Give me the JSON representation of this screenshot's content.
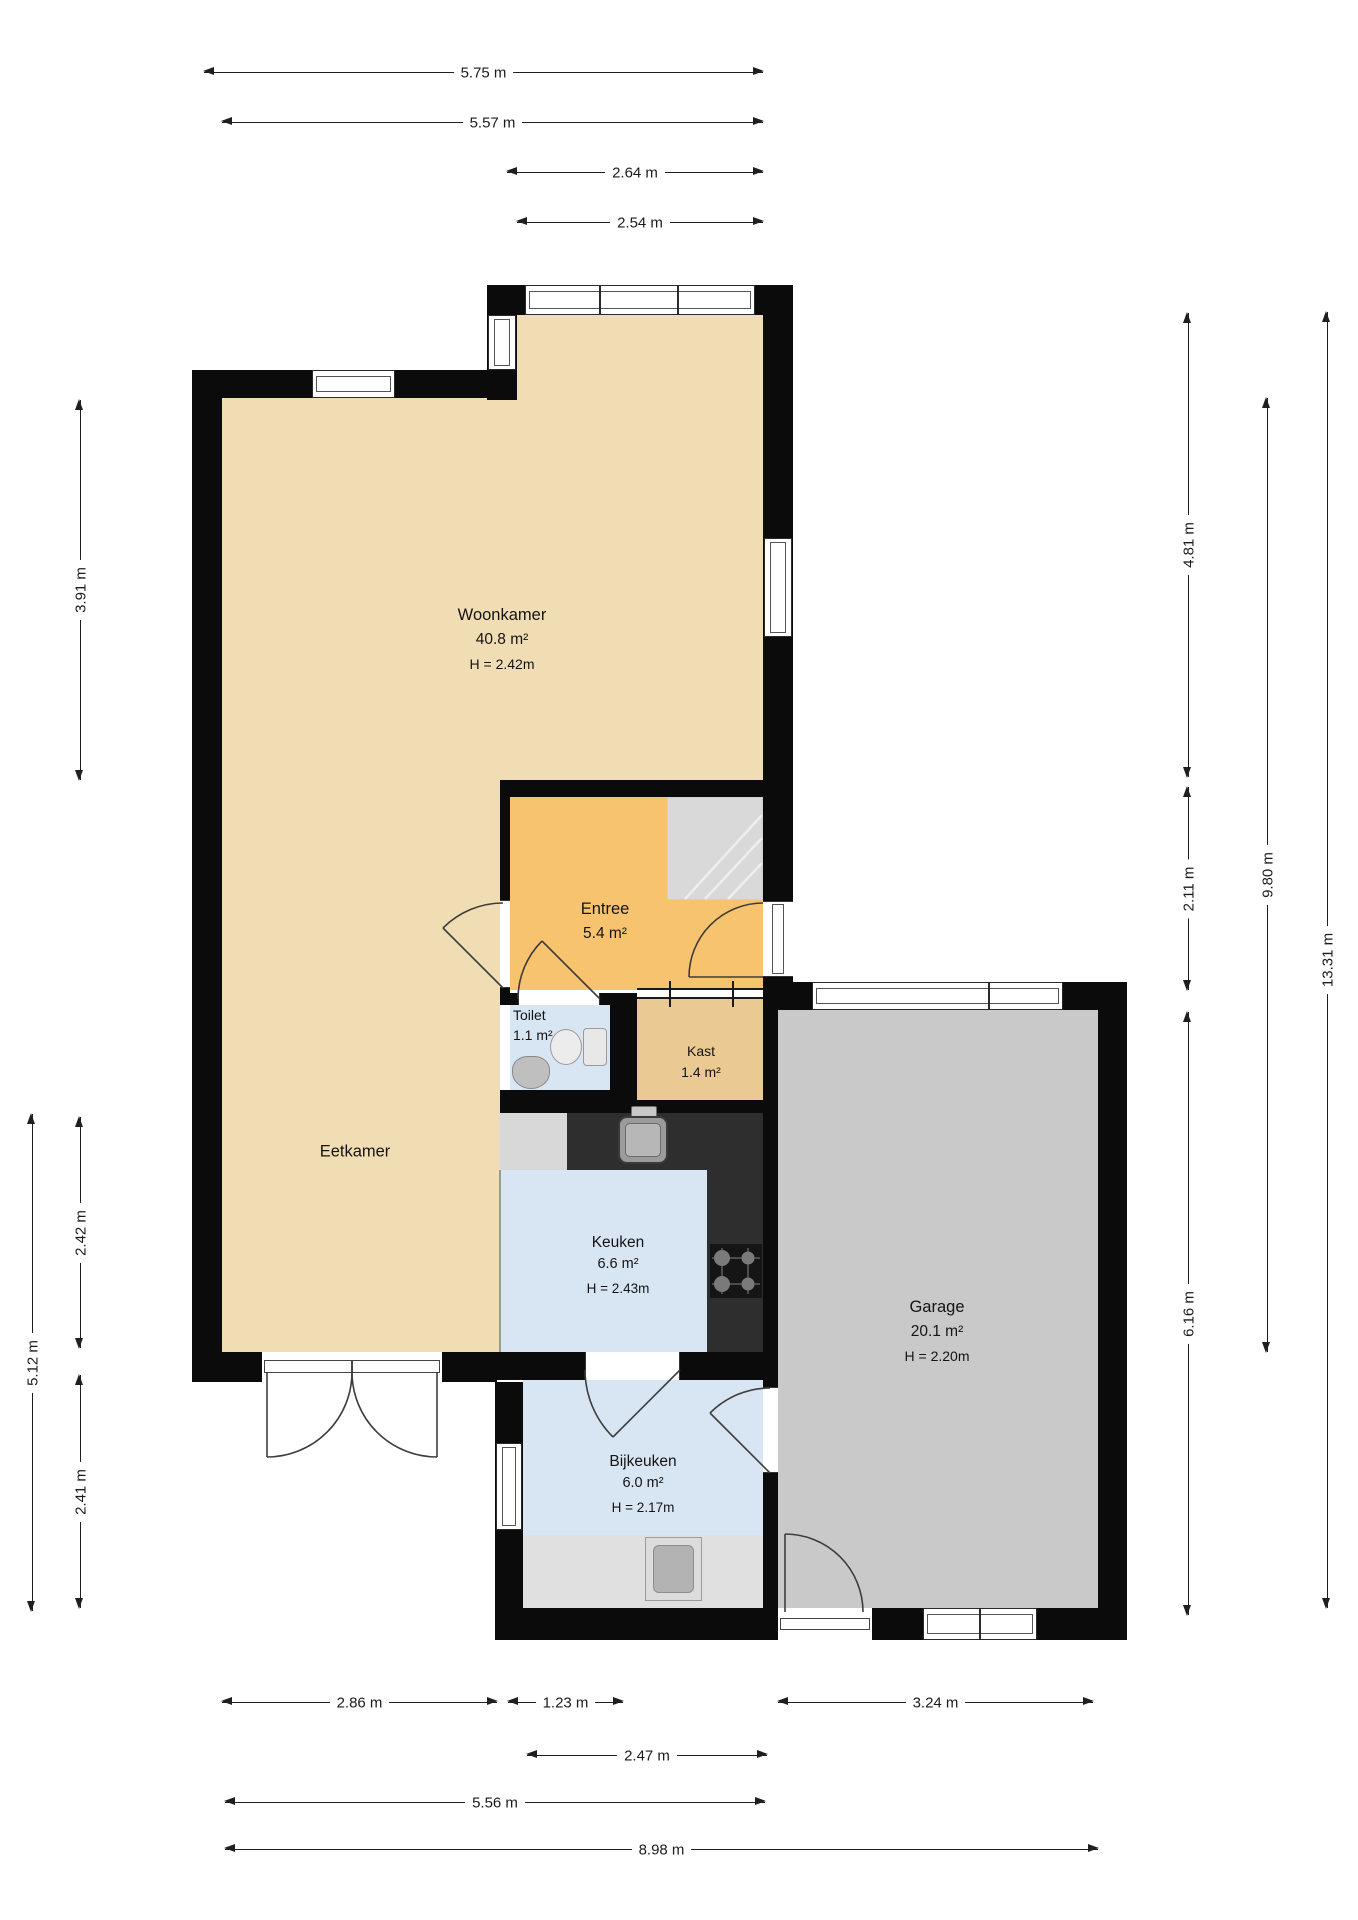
{
  "rooms": {
    "woonkamer": {
      "name": "Woonkamer",
      "area": "40.8 m²",
      "ceiling": "H = 2.42m"
    },
    "entree": {
      "name": "Entree",
      "area": "5.4 m²"
    },
    "toilet": {
      "name": "Toilet",
      "area": "1.1 m²"
    },
    "kast": {
      "name": "Kast",
      "area": "1.4 m²"
    },
    "eetkamer": {
      "name": "Eetkamer"
    },
    "keuken": {
      "name": "Keuken",
      "area": "6.6 m²",
      "ceiling": "H = 2.43m"
    },
    "bijkeuken": {
      "name": "Bijkeuken",
      "area": "6.0 m²",
      "ceiling": "H = 2.17m"
    },
    "garage": {
      "name": "Garage",
      "area": "20.1 m²",
      "ceiling": "H = 2.20m"
    }
  },
  "dimensions": {
    "top": [
      "5.75 m",
      "5.57 m",
      "2.64 m",
      "2.54 m"
    ],
    "bottom": [
      "2.86 m",
      "1.23 m",
      "3.24 m",
      "2.47 m",
      "5.56 m",
      "8.98 m"
    ],
    "left": [
      "3.91 m",
      "2.42 m",
      "2.41 m",
      "5.12 m"
    ],
    "right": [
      "4.81 m",
      "2.11 m",
      "6.16 m",
      "9.80 m",
      "13.31 m"
    ]
  },
  "colors": {
    "wall": "#0b0b0b",
    "floor_living": "#f1ddb4",
    "floor_entree": "#f8c36e",
    "floor_kast": "#ebc993",
    "floor_wet": "#d8e5f3",
    "floor_garage": "#c9c9c9",
    "counter_dark": "#2e2e2e",
    "cabinet_gray": "#d8d8d8",
    "stairs_gray": "#d9d9d9",
    "dimension_text": "#1b1b1b"
  },
  "icons": [
    "stairs-icon",
    "toilet-icon",
    "washbasin-icon",
    "kitchen-sink-icon",
    "stove-icon",
    "washing-machine-icon"
  ]
}
